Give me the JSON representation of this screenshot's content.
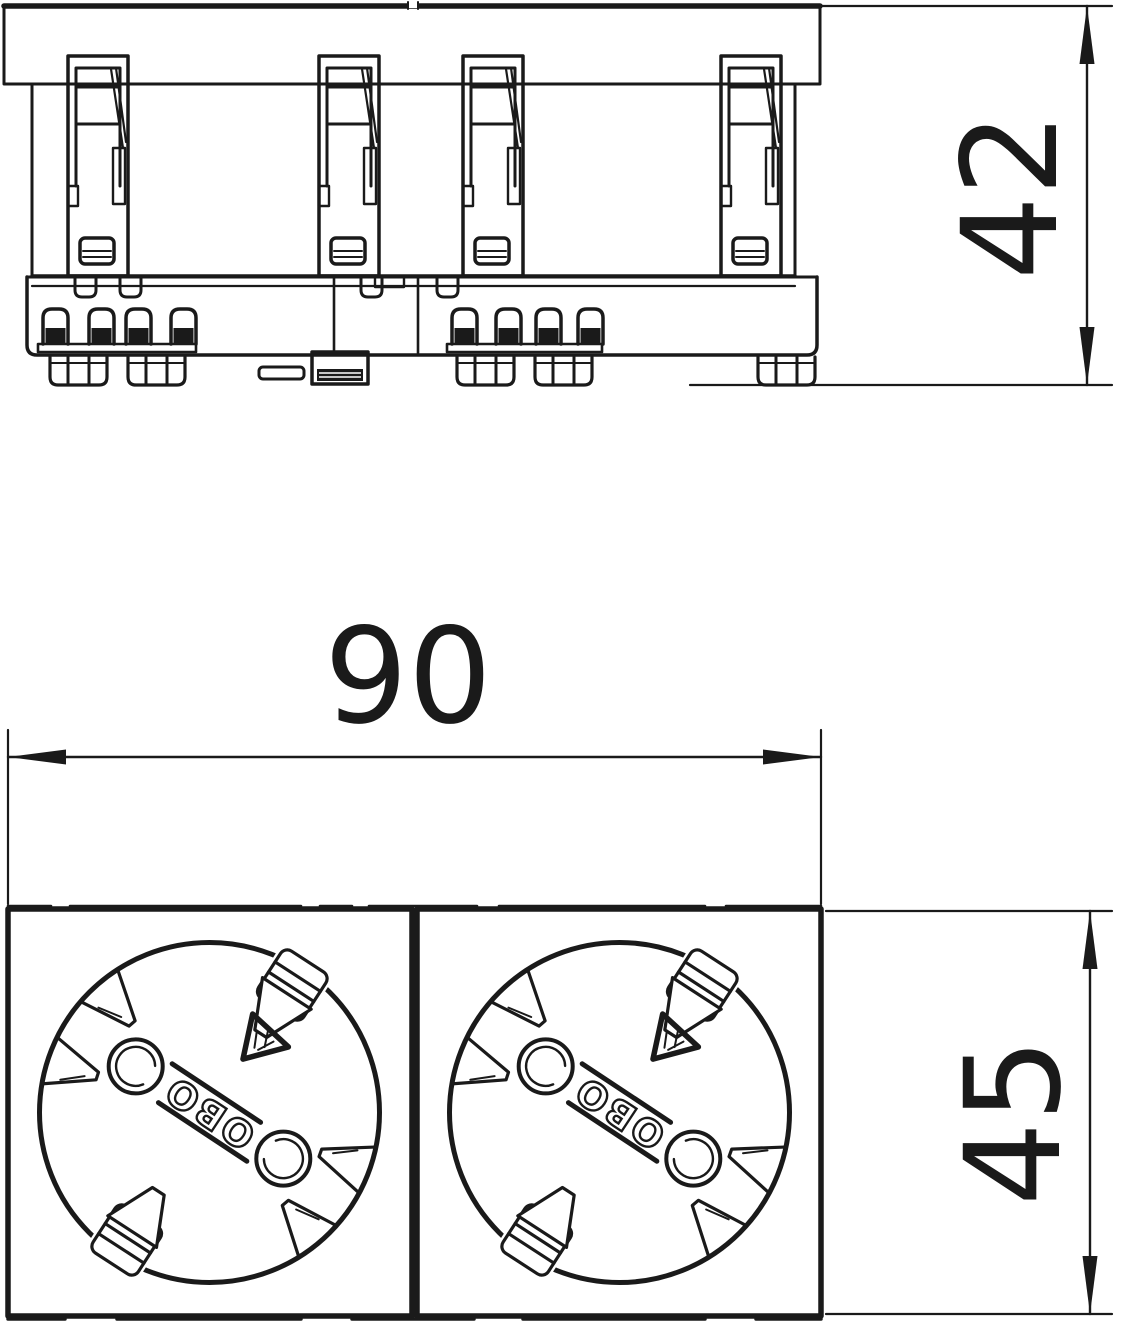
{
  "page": {
    "background_color": "#ffffff",
    "line_color": "#1a1a1a"
  },
  "dimensions": {
    "overall_width": "90",
    "side_height": "42",
    "module_size": "45"
  },
  "branding": {
    "molded_logo": "OBO"
  },
  "symbols": {
    "approval_mark": "triangle-approval-icon"
  }
}
